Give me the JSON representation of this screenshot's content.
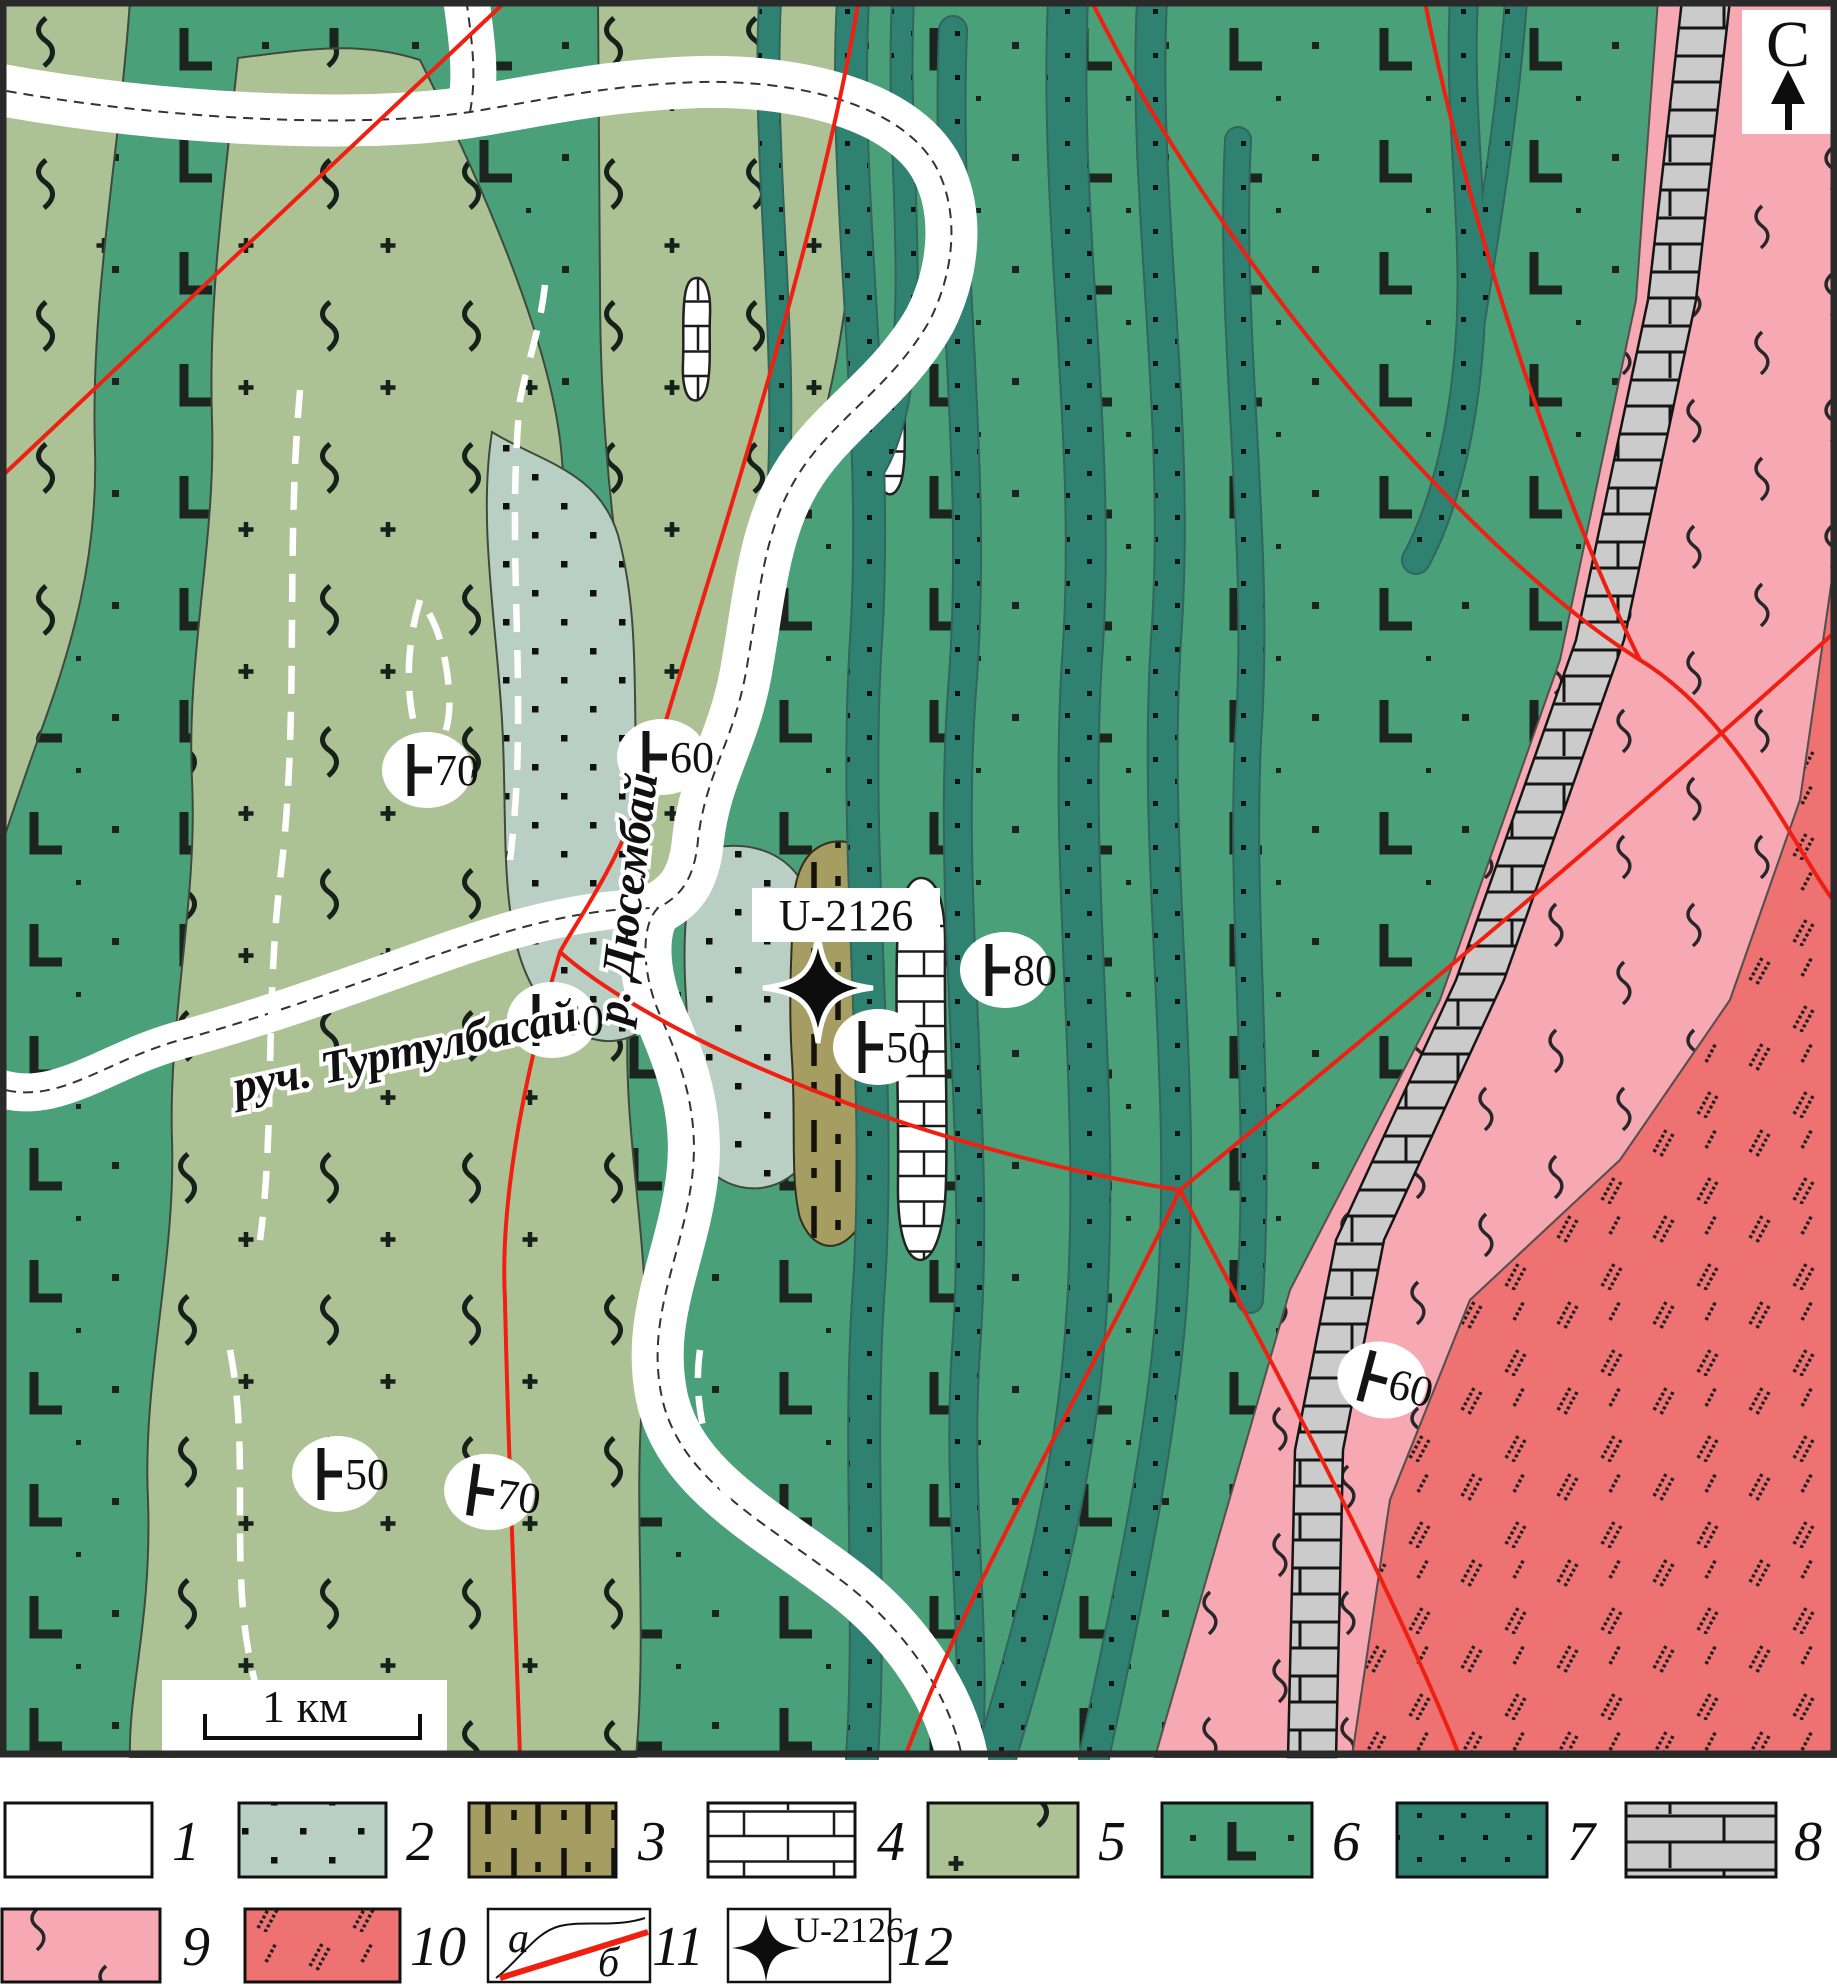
{
  "map": {
    "north_label": "С",
    "scale_label": "1 км",
    "river_label": "р. Дюсембай",
    "stream_label": "руч. Туртулбасай",
    "sample_station": {
      "label": "U-2126"
    },
    "dip_markers": [
      {
        "value": "70"
      },
      {
        "value": "60"
      },
      {
        "value": "50"
      },
      {
        "value": "80"
      },
      {
        "value": "50"
      },
      {
        "value": "50"
      },
      {
        "value": "70"
      },
      {
        "value": "60"
      }
    ],
    "colors": {
      "unit2_pale_dotted": "#bacfc3",
      "unit3_khaki_dashed": "#a69d62",
      "unit4_white_brick": "#ffffff",
      "unit5_olive_zigzag": "#adc294",
      "unit6_green_L": "#4aa179",
      "unit7_teal_dotted": "#2f8172",
      "unit8_gray_brick": "#cbcbcb",
      "unit9_pink": "#f6a8b3",
      "unit10_red_hatch": "#ee7271",
      "fault_line": "#ef2012",
      "pattern_ink": "#1b211d"
    }
  },
  "legend": {
    "items": [
      {
        "number": "1"
      },
      {
        "number": "2"
      },
      {
        "number": "3"
      },
      {
        "number": "4"
      },
      {
        "number": "5"
      },
      {
        "number": "6"
      },
      {
        "number": "7"
      },
      {
        "number": "8"
      },
      {
        "number": "9"
      },
      {
        "number": "10"
      },
      {
        "number": "11",
        "line_a_label": "а",
        "line_b_label": "б"
      },
      {
        "number": "12",
        "station_label": "U-2126"
      }
    ]
  }
}
